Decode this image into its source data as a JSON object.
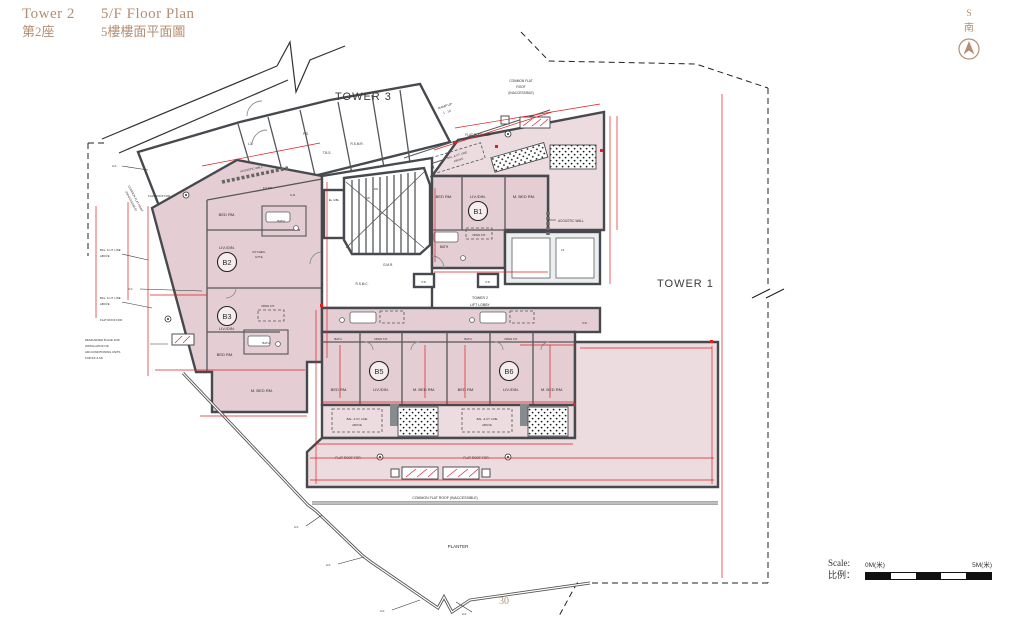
{
  "header": {
    "tower_en": "Tower 2",
    "tower_zh": "第2座",
    "plan_en": "5/F Floor Plan",
    "plan_zh": "5樓樓面平面圖"
  },
  "compass": {
    "s": "S",
    "south": "南"
  },
  "scale_bar": {
    "label_en": "Scale:",
    "label_zh": "比例：",
    "zero": "0M(米)",
    "five": "5M(米)"
  },
  "footer": {
    "page_number": "30"
  },
  "plan": {
    "tower1": "TOWER 1",
    "tower3": "TOWER 3",
    "units": {
      "b1": "B1",
      "b2": "B2",
      "b3": "B3",
      "b5": "B5",
      "b6": "B6"
    },
    "rooms": {
      "bed": "BED RM.",
      "mbed": "M. BED RM.",
      "liv": "LIV./DIN.",
      "bath": "BATH",
      "openkit": "OPEN KIT.",
      "kitchen1": "KITCHEN-",
      "kitchen2": "ETTE"
    },
    "labels": {
      "cfr_1": "COMMON FLAT",
      "cfr_2": "ROOF",
      "cfr_inac": "(INACCESSIBLE)",
      "cfr_line": "COMMON FLAT ROOF",
      "cfr_full": "COMMON FLAT ROOF (INACCESSIBLE)",
      "flat_roof_for": "FLAT ROOF FOR",
      "bal_ut_1": "BAL. & UT. LINE",
      "bal_ut_2": "ABOVE",
      "ramp_up": "RAMP UP",
      "ramp_slope": "1 : 12",
      "tower2": "TOWER 2",
      "lift_lobby": "LIFT LOBBY",
      "acoustic": "ACOUSTIC WALL",
      "planter": "PLANTER",
      "designated_1": "DESIGNATED PLACE FOR",
      "designated_2": "INSTALLATION OF",
      "designated_3": "AIR-CONDITIONING UNITS",
      "designated_4": "FOR 5/F & 6/F",
      "af": "A.F.",
      "pd": "P.D.",
      "tbs": "T.B.S.",
      "rsmr": "R.S.M.R.",
      "ad": "A.D.",
      "el": "EL./UBL",
      "dn": "DN",
      "up": "UP",
      "gmr": "G.M.R.",
      "rsmc": "R.S.M.C.",
      "fspd": "F.S.P.D.",
      "hr": "H.R.",
      "l3": "L3"
    }
  }
}
